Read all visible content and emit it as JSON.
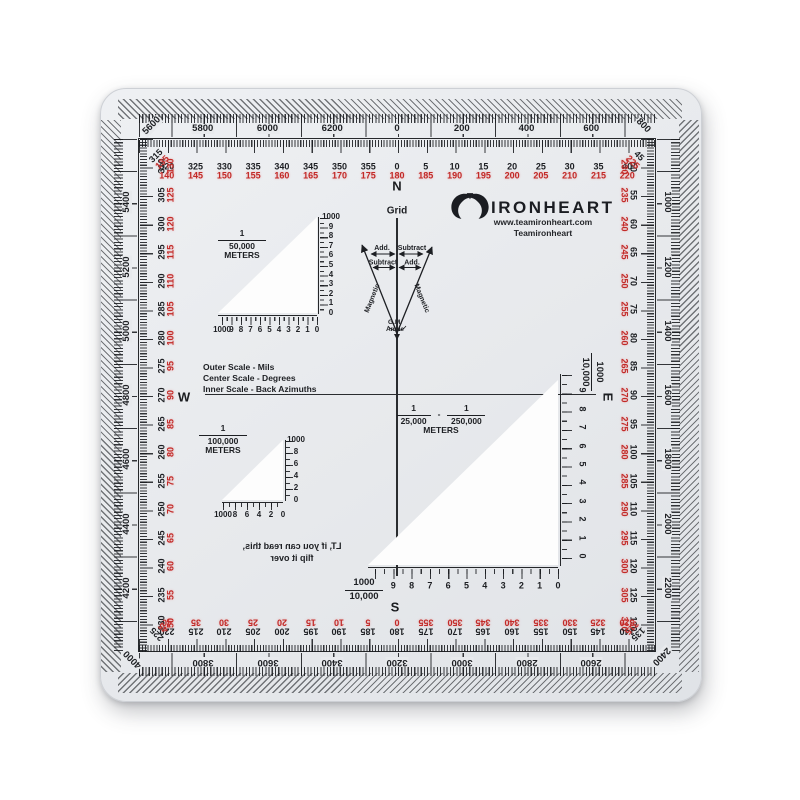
{
  "brand": {
    "name": "IRONHEART",
    "url": "www.teamironheart.com",
    "social": "Teamironheart"
  },
  "compass": {
    "north": "N",
    "south": "S",
    "east": "E",
    "west": "W"
  },
  "declination": {
    "grid": "Grid",
    "top_left": "Add.",
    "top_right": "Subtract",
    "mid_left": "Subtract",
    "mid_right": "Add.",
    "left_line": "Magnetic",
    "right_line": "Magnetic",
    "vertex_line1": "G.M.",
    "vertex_line2": "Angle"
  },
  "notes": {
    "lines": [
      "Outer Scale - Mils",
      "Center Scale - Degrees",
      "Inner Scale - Back Azimuths"
    ]
  },
  "flip_note": {
    "lines": [
      "LT, if you can read this,",
      "flip it over"
    ]
  },
  "mils_scale": {
    "corners": {
      "top_left": "5600",
      "top_right": "800",
      "bottom_right": "2400",
      "bottom_left": "4000"
    },
    "top": [
      "5800",
      "6000",
      "6200",
      "0",
      "200",
      "400",
      "600"
    ],
    "right": [
      "1000",
      "1200",
      "1400",
      "1600",
      "1800",
      "2000",
      "2200"
    ],
    "bottom": [
      "2600",
      "2800",
      "3000",
      "3200",
      "3400",
      "3600",
      "3800"
    ],
    "left": [
      "4200",
      "4400",
      "4600",
      "4800",
      "5000",
      "5200",
      "5400"
    ]
  },
  "degree_scale": {
    "corners": {
      "top_left": [
        "315",
        "135"
      ],
      "top_right": [
        "45",
        "225"
      ],
      "bottom_right": [
        "135",
        "315"
      ],
      "bottom_left": [
        "225",
        "45"
      ]
    },
    "top": [
      [
        "320",
        "140"
      ],
      [
        "325",
        "145"
      ],
      [
        "330",
        "150"
      ],
      [
        "335",
        "155"
      ],
      [
        "340",
        "160"
      ],
      [
        "345",
        "165"
      ],
      [
        "350",
        "170"
      ],
      [
        "355",
        "175"
      ],
      [
        "0",
        "180"
      ],
      [
        "5",
        "185"
      ],
      [
        "10",
        "190"
      ],
      [
        "15",
        "195"
      ],
      [
        "20",
        "200"
      ],
      [
        "25",
        "205"
      ],
      [
        "30",
        "210"
      ],
      [
        "35",
        "215"
      ],
      [
        "40",
        "220"
      ]
    ],
    "right": [
      [
        "50",
        "230"
      ],
      [
        "55",
        "235"
      ],
      [
        "60",
        "240"
      ],
      [
        "65",
        "245"
      ],
      [
        "70",
        "250"
      ],
      [
        "75",
        "255"
      ],
      [
        "80",
        "260"
      ],
      [
        "85",
        "265"
      ],
      [
        "90",
        "270"
      ],
      [
        "95",
        "275"
      ],
      [
        "100",
        "280"
      ],
      [
        "105",
        "285"
      ],
      [
        "110",
        "290"
      ],
      [
        "115",
        "295"
      ],
      [
        "120",
        "300"
      ],
      [
        "125",
        "305"
      ],
      [
        "130",
        "310"
      ]
    ],
    "bottom": [
      [
        "140",
        "320"
      ],
      [
        "145",
        "325"
      ],
      [
        "150",
        "330"
      ],
      [
        "155",
        "335"
      ],
      [
        "160",
        "340"
      ],
      [
        "165",
        "345"
      ],
      [
        "170",
        "350"
      ],
      [
        "175",
        "355"
      ],
      [
        "180",
        "0"
      ],
      [
        "185",
        "5"
      ],
      [
        "190",
        "10"
      ],
      [
        "195",
        "15"
      ],
      [
        "200",
        "20"
      ],
      [
        "205",
        "25"
      ],
      [
        "210",
        "30"
      ],
      [
        "215",
        "35"
      ],
      [
        "220",
        "40"
      ]
    ],
    "left": [
      [
        "230",
        "50"
      ],
      [
        "235",
        "55"
      ],
      [
        "240",
        "60"
      ],
      [
        "245",
        "65"
      ],
      [
        "250",
        "70"
      ],
      [
        "255",
        "75"
      ],
      [
        "260",
        "80"
      ],
      [
        "265",
        "85"
      ],
      [
        "270",
        "90"
      ],
      [
        "275",
        "95"
      ],
      [
        "280",
        "100"
      ],
      [
        "285",
        "105"
      ],
      [
        "290",
        "110"
      ],
      [
        "295",
        "115"
      ],
      [
        "300",
        "120"
      ],
      [
        "305",
        "125"
      ],
      [
        "310",
        "130"
      ]
    ]
  },
  "triangles": {
    "scale_50k": {
      "fraction": [
        "1",
        "50,000"
      ],
      "unit": "METERS",
      "bottom_labels": [
        "1000",
        "9",
        "8",
        "7",
        "6",
        "5",
        "4",
        "3",
        "2",
        "1",
        "0"
      ],
      "side_labels": [
        "0",
        "1",
        "2",
        "3",
        "4",
        "5",
        "6",
        "7",
        "8",
        "9",
        "1000"
      ]
    },
    "scale_100k": {
      "fraction": [
        "1",
        "100,000"
      ],
      "unit": "METERS",
      "bottom_labels": [
        "1000",
        "8",
        "6",
        "4",
        "2",
        "0"
      ],
      "side_labels": [
        "0",
        "2",
        "4",
        "6",
        "8",
        "1000"
      ]
    },
    "scale_25k": {
      "fractions": [
        [
          "1",
          "25,000"
        ],
        [
          "1",
          "250,000"
        ]
      ],
      "separator": "-",
      "unit": "METERS",
      "ruler_fraction": [
        "1000",
        "10,000"
      ],
      "bottom_labels": [
        "9",
        "8",
        "7",
        "6",
        "5",
        "4",
        "3",
        "2",
        "1",
        "0"
      ],
      "side_labels": [
        "9",
        "8",
        "7",
        "6",
        "5",
        "4",
        "3",
        "2",
        "1",
        "0"
      ]
    }
  },
  "colors": {
    "red": "#c22a28",
    "black": "#1d1f23",
    "face": "#e8eaed"
  }
}
